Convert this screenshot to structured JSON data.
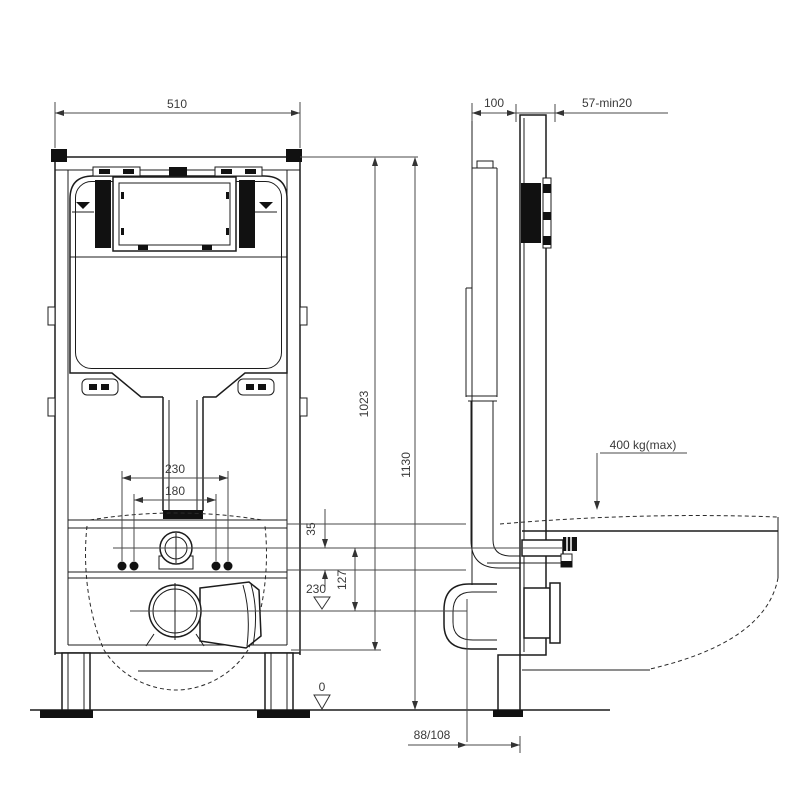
{
  "drawing": {
    "type": "technical-installation-drawing",
    "subject": "wall-hung WC concealed cistern mounting frame, front and side views",
    "line_color": "#1c1c1c",
    "background": "#ffffff",
    "dims": {
      "front_width": "510",
      "frame_depth": "100",
      "wall_distance": "57-min20",
      "height_body": "1023",
      "height_total": "1130",
      "bolt_outer": "230",
      "bolt_inner": "180",
      "inlet_offset": "35",
      "inlet_drain": "127",
      "drain_level": "230",
      "floor_level": "0",
      "max_load": "400 kg(max)",
      "drain_offset": "88/108"
    }
  }
}
